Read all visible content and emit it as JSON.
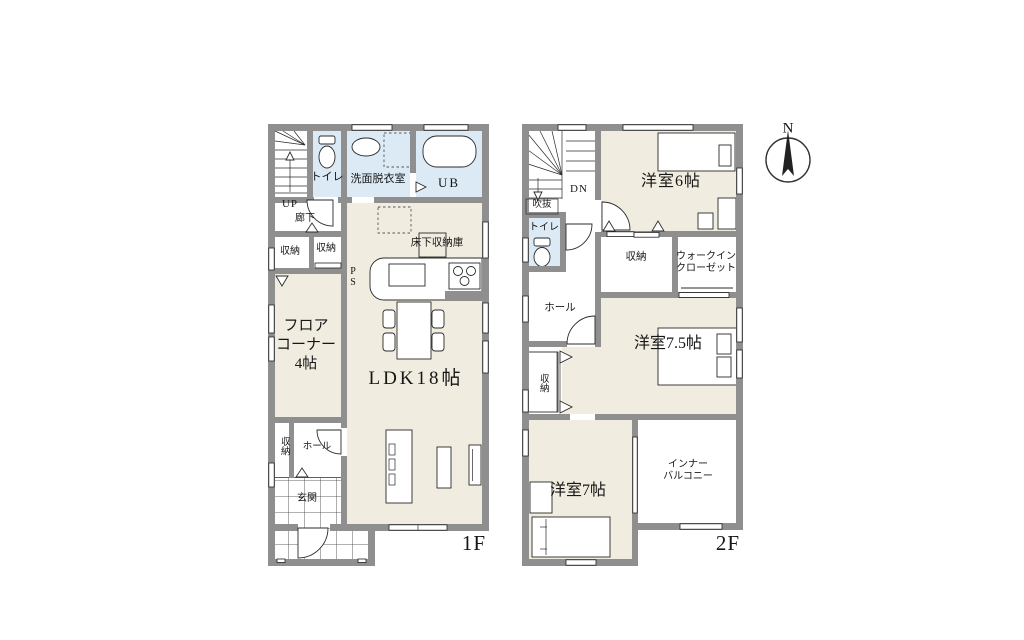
{
  "colors": {
    "wall": "#8f8f8f",
    "room_beige": "#f0ecdf",
    "wet_blue": "#dceaf6",
    "line": "#2b2b2b",
    "background": "#ffffff"
  },
  "compass": {
    "north": "N"
  },
  "floor1": {
    "floor_label": "1F",
    "stairs_up": "UP",
    "hallway": "廊下",
    "toilet": "トイレ",
    "washroom": "洗面脱衣室",
    "unit_bath": "UB",
    "storage_a": "収納",
    "storage_b": "収納",
    "pipe_space": "P\nS",
    "underfloor_storage": "床下収納庫",
    "floor_corner": "フロア\nコーナー\n4帖",
    "ldk": "LDK18帖",
    "storage_c": "収納",
    "hall": "ホール",
    "entrance": "玄関"
  },
  "floor2": {
    "floor_label": "2F",
    "stairs_down": "DN",
    "void": "吹抜",
    "toilet": "トイレ",
    "western_room_6": "洋室6帖",
    "storage_a": "収納",
    "walk_in_closet": "ウォークイン\nクローゼット",
    "hall": "ホール",
    "storage_b": "収納",
    "western_room_7_5": "洋室7.5帖",
    "western_room_7": "洋室7帖",
    "inner_balcony": "インナー\nバルコニー"
  }
}
